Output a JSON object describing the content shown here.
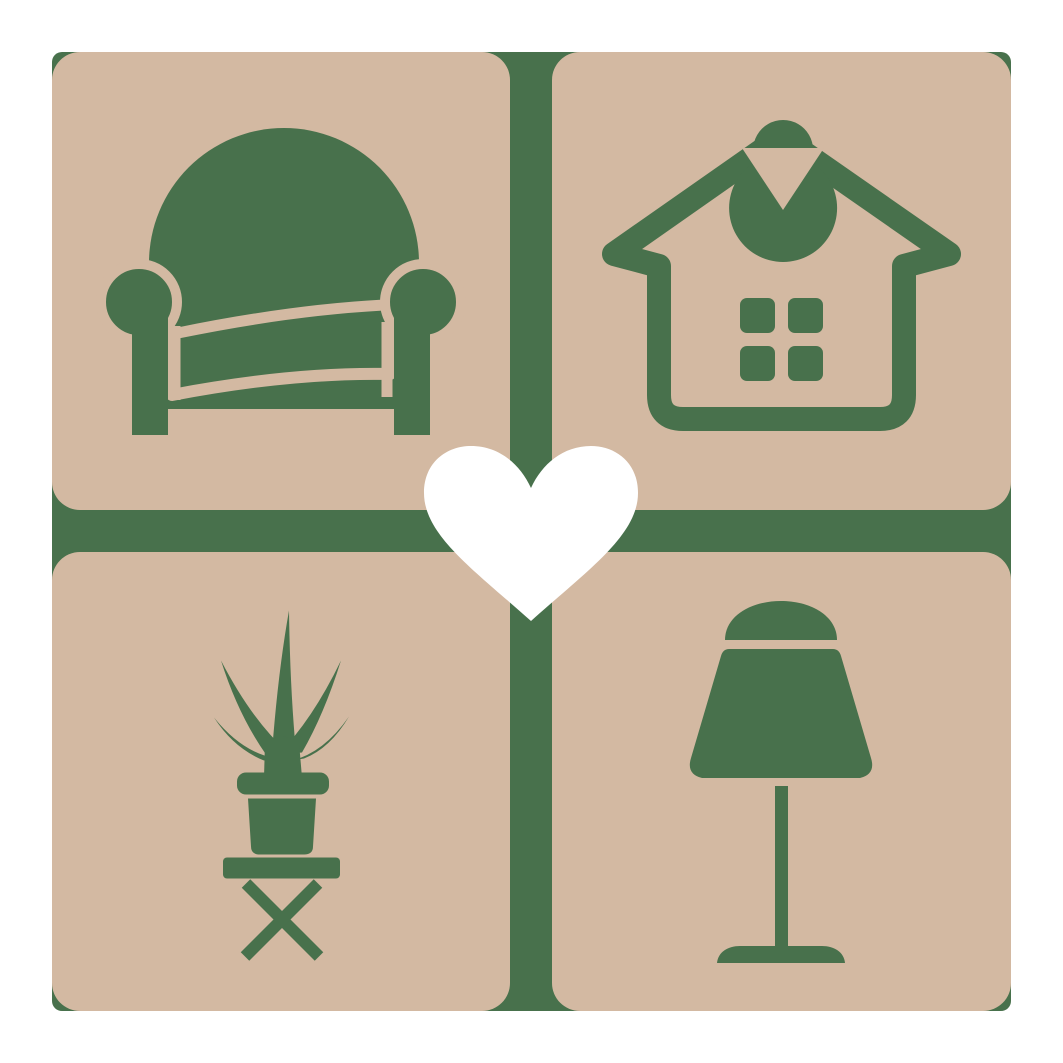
{
  "colors": {
    "page-bg": "#ffffff",
    "tile": "#d3b9a2",
    "green": "#48714c",
    "heart": "#ffffff"
  },
  "logo": {
    "grid": "2x2 rounded tiles on green cross background",
    "tiles": [
      {
        "position": "top-left",
        "icon": "armchair-icon",
        "label": "armchair"
      },
      {
        "position": "top-right",
        "icon": "house-icon",
        "label": "house"
      },
      {
        "position": "bottom-left",
        "icon": "potted-plant-icon",
        "label": "potted plant on stool"
      },
      {
        "position": "bottom-right",
        "icon": "table-lamp-icon",
        "label": "table lamp"
      }
    ],
    "center": {
      "icon": "heart-icon",
      "label": "heart"
    }
  }
}
